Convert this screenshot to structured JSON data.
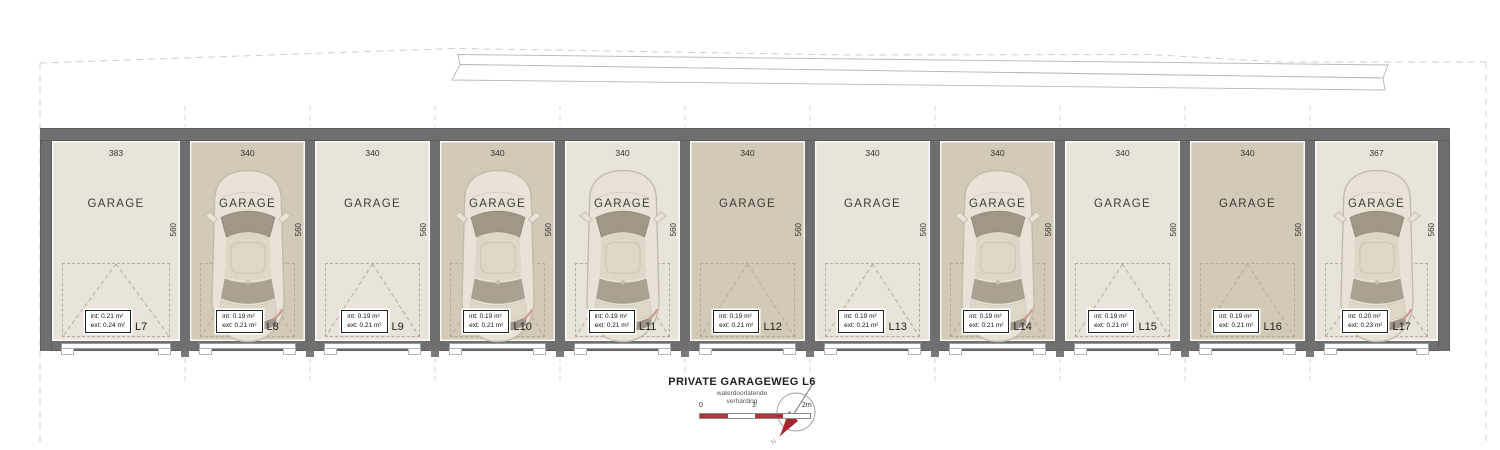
{
  "building": {
    "room_label": "GARAGE",
    "depth_dim": "560",
    "units": [
      {
        "id": "L7",
        "width_dim": "383",
        "int": "int: 0.21 m²",
        "ext": "ext: 0.24 m²",
        "car": false,
        "floor": "light"
      },
      {
        "id": "L8",
        "width_dim": "340",
        "int": "int: 0.19 m²",
        "ext": "ext: 0.21 m²",
        "car": true,
        "floor": "dark"
      },
      {
        "id": "L9",
        "width_dim": "340",
        "int": "int: 0.19 m²",
        "ext": "ext: 0.21 m²",
        "car": false,
        "floor": "light"
      },
      {
        "id": "L10",
        "width_dim": "340",
        "int": "int: 0.19 m²",
        "ext": "ext: 0.21 m²",
        "car": true,
        "floor": "dark"
      },
      {
        "id": "L11",
        "width_dim": "340",
        "int": "int: 0.19 m²",
        "ext": "ext: 0.21 m²",
        "car": true,
        "floor": "light"
      },
      {
        "id": "L12",
        "width_dim": "340",
        "int": "int: 0.19 m²",
        "ext": "ext: 0.21 m²",
        "car": false,
        "floor": "dark"
      },
      {
        "id": "L13",
        "width_dim": "340",
        "int": "int: 0.19 m²",
        "ext": "ext: 0.21 m²",
        "car": false,
        "floor": "light"
      },
      {
        "id": "L14",
        "width_dim": "340",
        "int": "int: 0.19 m²",
        "ext": "ext: 0.21 m²",
        "car": true,
        "floor": "dark"
      },
      {
        "id": "L15",
        "width_dim": "340",
        "int": "int: 0.19 m²",
        "ext": "ext: 0.21 m²",
        "car": false,
        "floor": "light"
      },
      {
        "id": "L16",
        "width_dim": "340",
        "int": "int: 0.19 m²",
        "ext": "ext: 0.21 m²",
        "car": false,
        "floor": "dark"
      },
      {
        "id": "L17",
        "width_dim": "367",
        "int": "int: 0.20 m²",
        "ext": "ext: 0.23 m²",
        "car": true,
        "floor": "light"
      }
    ]
  },
  "road": {
    "title": "PRIVATE GARAGEWEG L6",
    "subtitle_line1": "waterdoorlatende",
    "subtitle_line2": "verharding"
  },
  "scale_bar": {
    "label_0": "0",
    "label_1": "1",
    "label_2": "2m"
  },
  "compass": {
    "north_label": "N"
  },
  "colors": {
    "wall_gray": "#6f6f6f",
    "floor_light": "#e9e4da",
    "floor_dark": "#d2c9b6",
    "scale_red": "#ae3337",
    "needle_red": "#a72730",
    "boundary_dash": "#cfcfcf",
    "strip_line": "#b8b8b8"
  }
}
